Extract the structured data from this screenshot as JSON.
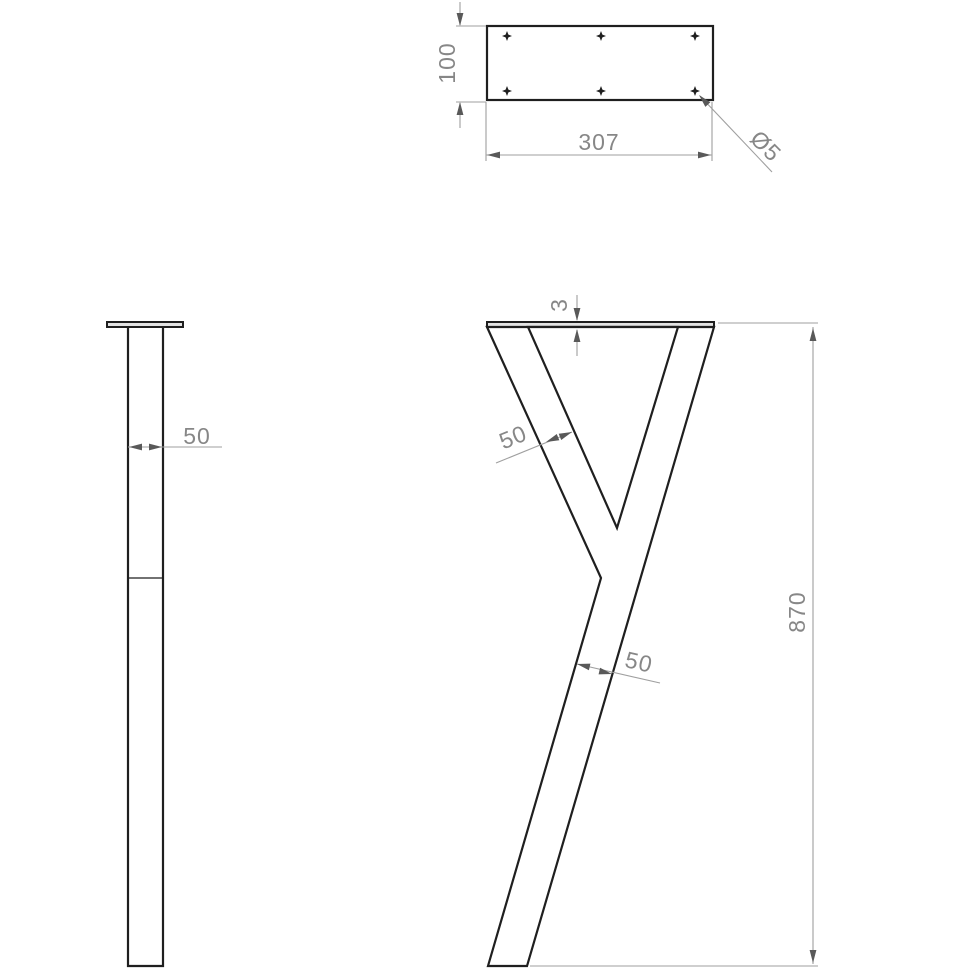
{
  "dimensions": {
    "plate": {
      "width": "307",
      "height": "100",
      "hole_diameter": "Ø5"
    },
    "side": {
      "profile_width": "50"
    },
    "front": {
      "plate_thickness": "3",
      "arm_width": "50",
      "stem_width": "50",
      "overall_height": "870"
    }
  },
  "hole_count": 6,
  "colors": {
    "part_line": "#1f1f1f",
    "dim_line": "#9f9f9f",
    "arrow": "#595959",
    "dim_text": "#878787",
    "plate_fill": "#e3e3e3",
    "background": "#ffffff"
  }
}
